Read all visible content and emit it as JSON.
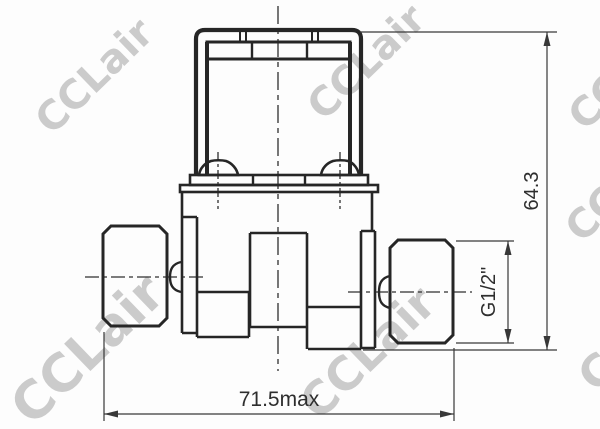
{
  "drawing": {
    "annotations": {
      "overall_height": "64.3",
      "overall_width": "71.5max",
      "port_thread": "G1/2\""
    },
    "watermark": {
      "text": "CCLair"
    },
    "colors": {
      "line": "#262626",
      "dimension_line": "#383838",
      "watermark": "#c7c7c7",
      "background": "#fdfdfd"
    }
  }
}
